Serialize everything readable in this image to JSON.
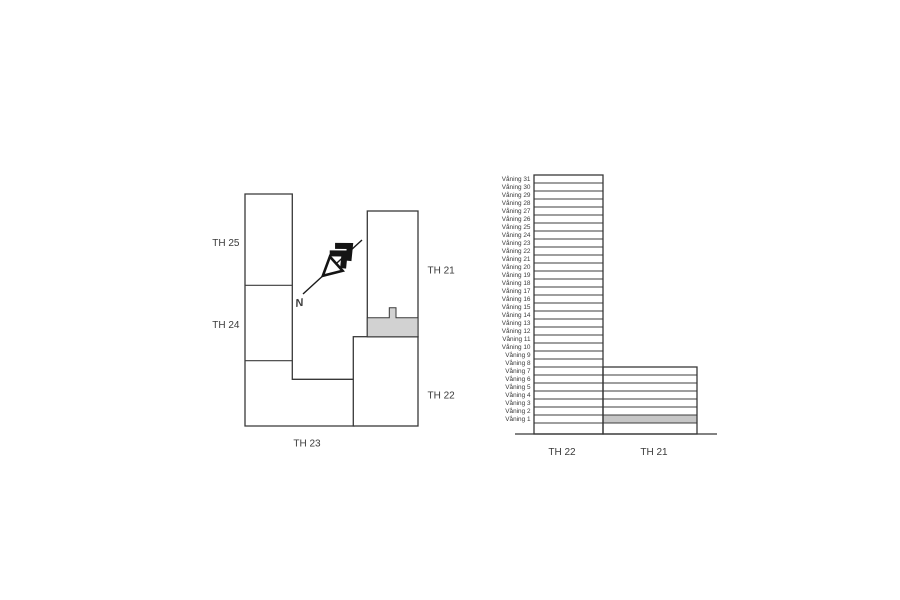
{
  "site_plan": {
    "labels": {
      "th25": "TH 25",
      "th24": "TH 24",
      "th23": "TH 23",
      "th21": "TH 21",
      "th22": "TH 22"
    },
    "north_label": "N",
    "highlighted_area_building": "TH 21"
  },
  "elevation": {
    "floors": [
      "Våning 31",
      "Våning 30",
      "Våning 29",
      "Våning 28",
      "Våning 27",
      "Våning 26",
      "Våning 25",
      "Våning 24",
      "Våning 23",
      "Våning 22",
      "Våning 21",
      "Våning 20",
      "Våning 19",
      "Våning 18",
      "Våning 17",
      "Våning 16",
      "Våning 15",
      "Våning 14",
      "Våning 13",
      "Våning 12",
      "Våning 11",
      "Våning 10",
      "Våning 9",
      "Våning 8",
      "Våning 7",
      "Våning 6",
      "Våning 5",
      "Våning 4",
      "Våning 3",
      "Våning 2",
      "Våning 1"
    ],
    "towers": [
      {
        "label": "TH 22",
        "floor_count": 31
      },
      {
        "label": "TH 21",
        "floor_count": 7
      }
    ],
    "highlighted_floor": "Våning 1",
    "highlighted_building": "TH 21"
  },
  "colors": {
    "background": "#ffffff",
    "line": "#383838",
    "text": "#3a3a3a",
    "highlight_plan": "#d2d2d2",
    "highlight_elevation": "#c6c6c6"
  }
}
